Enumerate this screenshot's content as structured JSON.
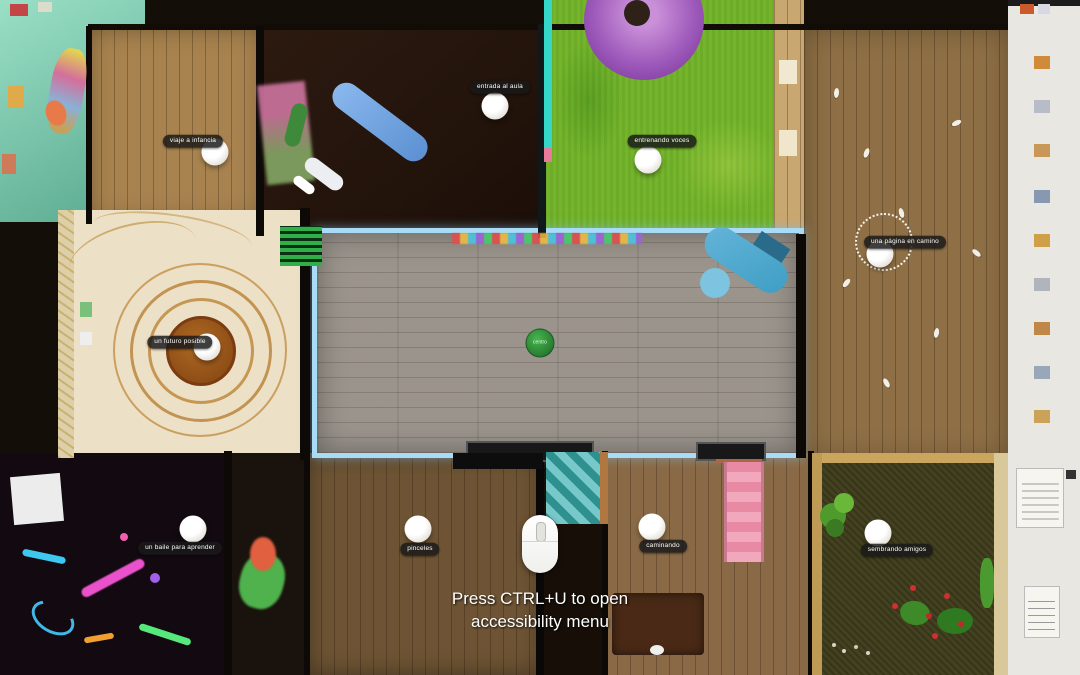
{
  "scene": {
    "description": "Top-down overhead view of a multi-room virtual exhibition house",
    "accessibility_hint_line1": "Press CTRL+U to open",
    "accessibility_hint_line2": "accessibility menu"
  },
  "markers": [
    {
      "id": "viaje-a-infancia",
      "label": "viaje a infancia"
    },
    {
      "id": "entrada-al-aula",
      "label": "entrada al aula"
    },
    {
      "id": "entrenando-voces",
      "label": "entrenando voces"
    },
    {
      "id": "una-pagina-en-camino",
      "label": "una página en camino"
    },
    {
      "id": "un-futuro-posible",
      "label": "un futuro posible"
    },
    {
      "id": "centro",
      "label": "centro"
    },
    {
      "id": "un-baile-para-aprender",
      "label": "un baile para aprender"
    },
    {
      "id": "pinceles",
      "label": "pinceles"
    },
    {
      "id": "caminando",
      "label": "caminando"
    },
    {
      "id": "sembrando-amigos",
      "label": "sembrando amigos"
    }
  ],
  "colors": {
    "grass_green": "#74b62a",
    "tree_canopy_purple": "#9a56b8",
    "hall_floor_gray": "#9a948c",
    "hall_glow_blue": "#a8dcf6",
    "wood_floor_tan": "#a8834f",
    "dark_studio_brown": "#2c1a10",
    "teal_room": "#7cc9b0",
    "art_room_cream": "#ece0c6",
    "spiral_orange": "#b97f35",
    "moss_floor": "#43411f",
    "neon_room_black": "#130911",
    "marker_pill_bg": "#1f1f1f",
    "center_badge_green": "#2f9e3f",
    "gallery_wall_white": "#e9e7e1"
  }
}
